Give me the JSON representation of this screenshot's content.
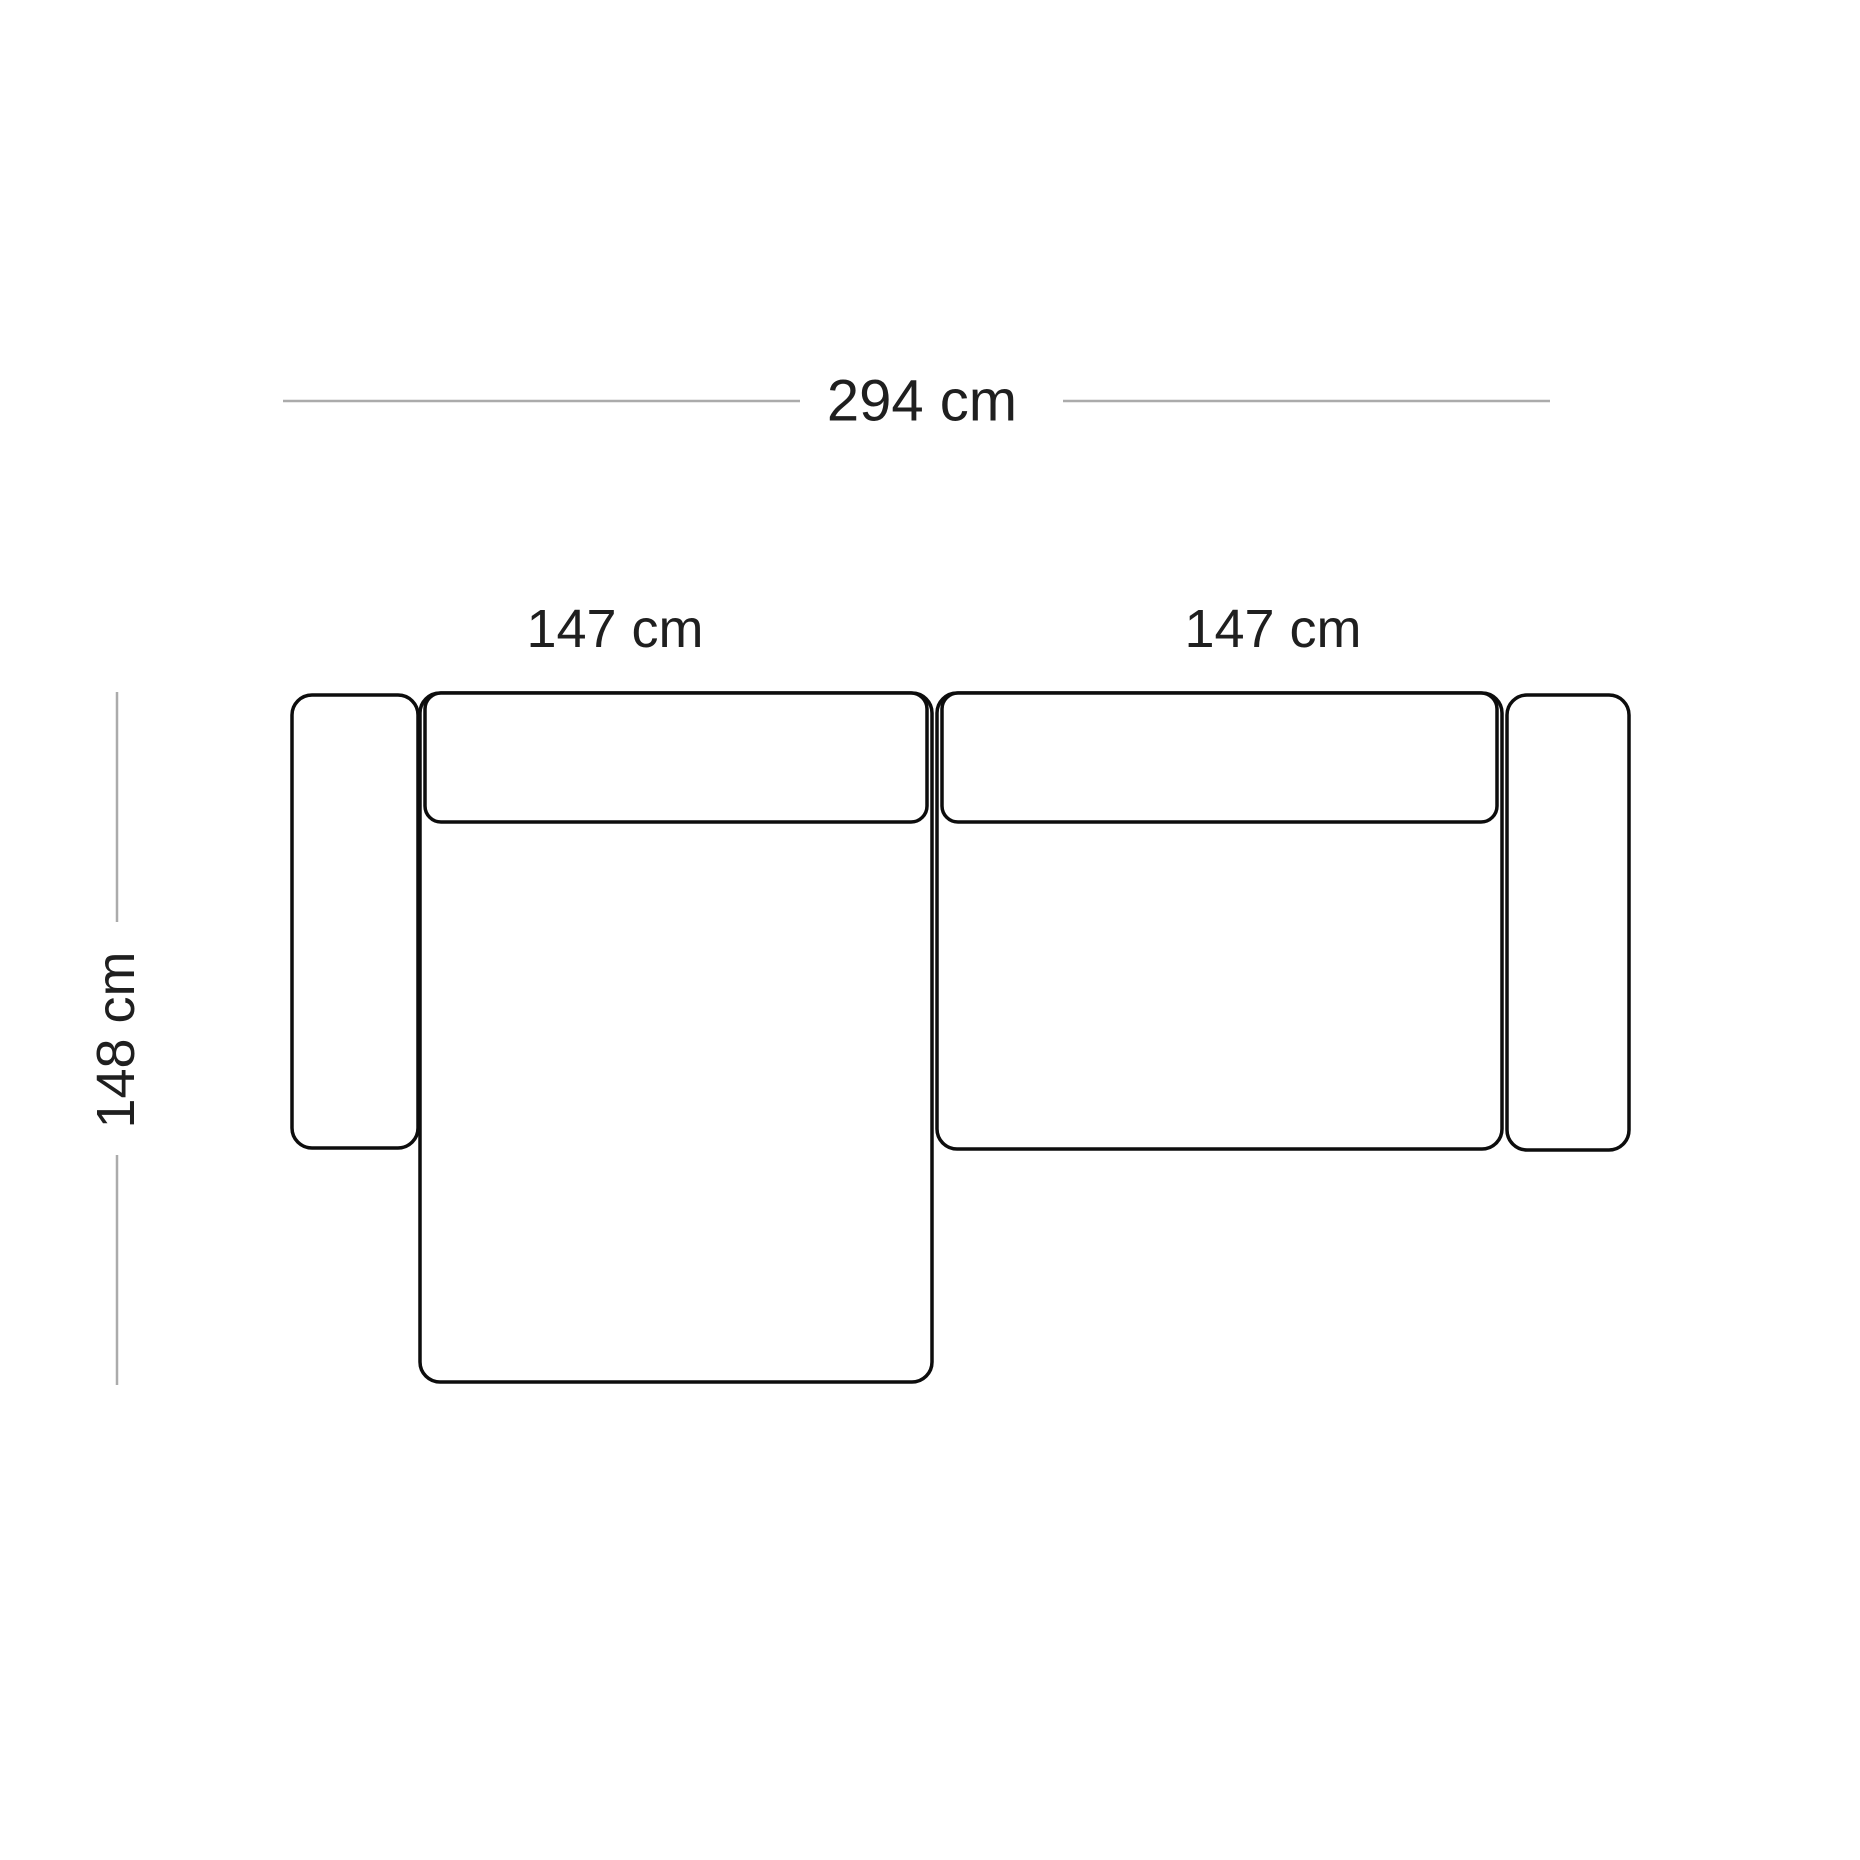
{
  "diagram": {
    "type": "furniture-dimension-top-view",
    "labels": {
      "total_width": "294 cm",
      "left_module_width": "147 cm",
      "right_module_width": "147 cm",
      "depth": "148 cm"
    },
    "colors": {
      "outline": "#0d0d0d",
      "dimension_line": "#ababab",
      "text": "#1f1f1f",
      "background": "#ffffff"
    }
  }
}
